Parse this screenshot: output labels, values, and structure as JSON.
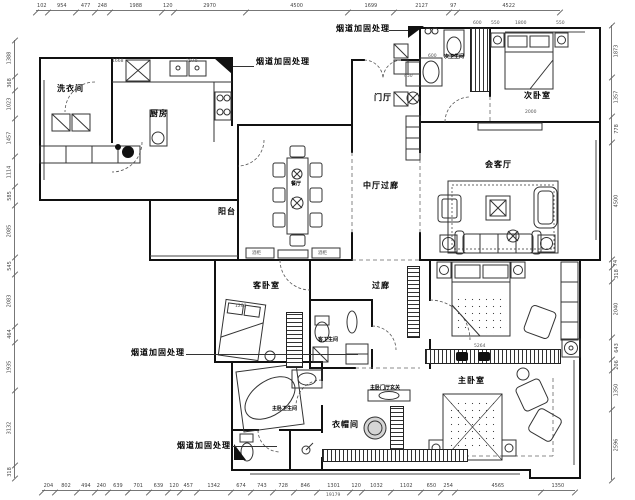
{
  "drawing": {
    "rooms": {
      "laundry": "洗衣间",
      "kitchen": "厨房",
      "dining": "餐厅",
      "balcony": "阳台",
      "foyer": "门厅",
      "central_hall": "中厅过廊",
      "sec_bath": "次卫生间",
      "sec_bedroom": "次卧室",
      "living": "会客厅",
      "guest_bedroom": "客卧室",
      "corridor": "过廊",
      "guest_bath": "客卫生间",
      "master_bath": "主卧卫生间",
      "closet": "衣帽间",
      "master_foyer": "主卧门厅玄关",
      "master_bedroom": "主卧室"
    },
    "annotation": {
      "flue": "烟道加固处理"
    },
    "furniture_labels": {
      "wine_cabinet": "酒柜"
    },
    "inline_dims": {
      "kitchen_left": "1668",
      "kitchen_right": "2970",
      "secbed_1": "600",
      "secbed_2": "550",
      "secbed_3": "1800",
      "secbed_4": "550",
      "secbed_width": "2000",
      "secbath_sink": "450",
      "secbath_door": "600",
      "guestbed_width": "1200",
      "master_wardrobe": "5264",
      "overall_width": "19179"
    },
    "dimensions": {
      "top": [
        "102",
        "954",
        "477",
        "248",
        "1988",
        "120",
        "2970",
        "4500",
        "1699",
        "2127",
        "97",
        "4522"
      ],
      "bottom": [
        "204",
        "802",
        "494",
        "240",
        "639",
        "701",
        "639",
        "120",
        "457",
        "1342",
        "674",
        "743",
        "728",
        "846",
        "1301",
        "120",
        "1032",
        "1102",
        "650",
        "254",
        "4565",
        "1350"
      ],
      "left": [
        "1388",
        "368",
        "1023",
        "1457",
        "1114",
        "585",
        "2085",
        "545",
        "2083",
        "464",
        "1935",
        "3132",
        "318"
      ],
      "right": [
        "1873",
        "1357",
        "778",
        "4500",
        "74",
        "318",
        "2040",
        "643",
        "206",
        "1350",
        "2596"
      ]
    }
  }
}
